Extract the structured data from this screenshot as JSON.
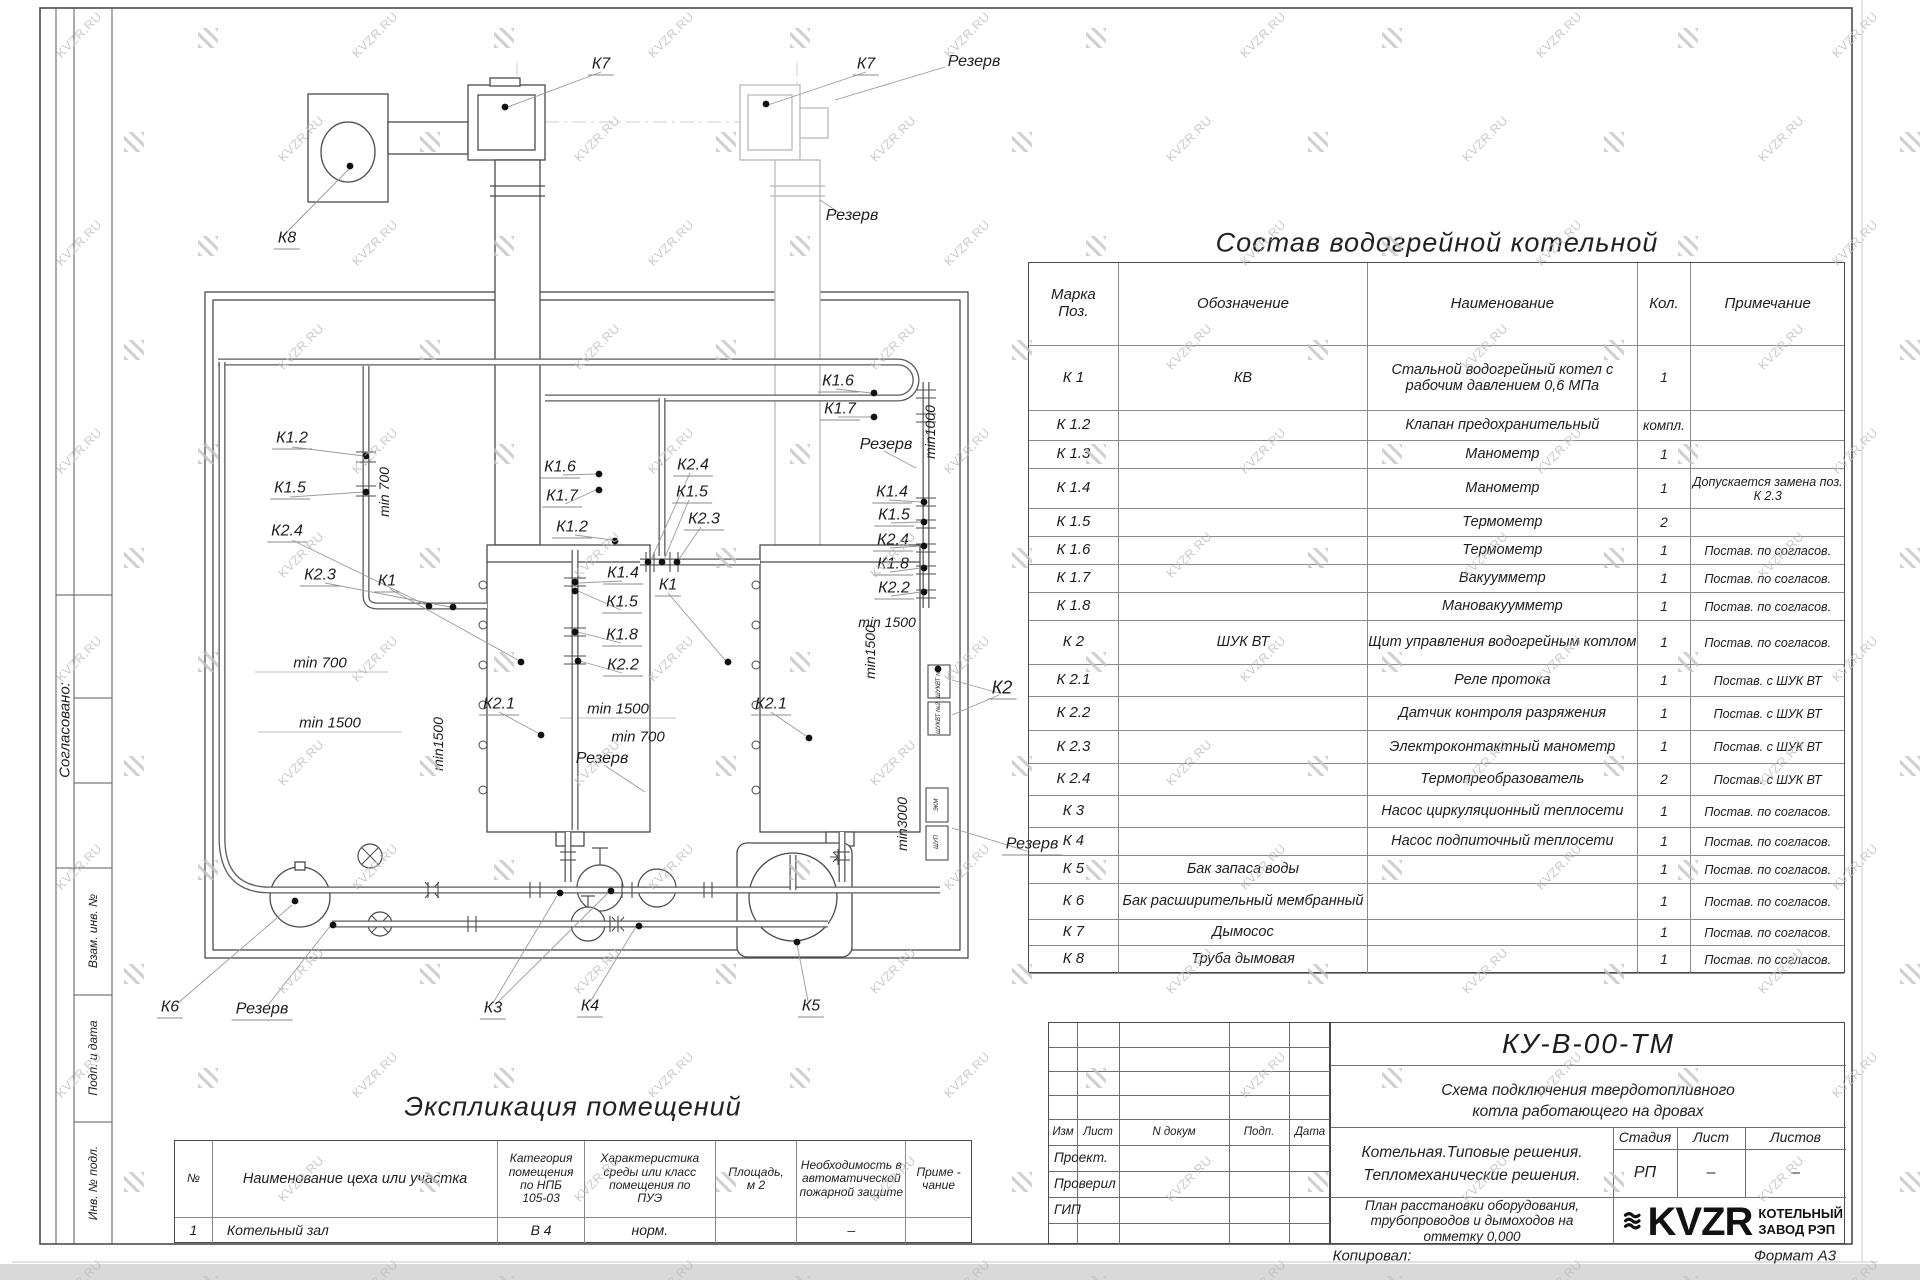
{
  "sheet": {
    "watermark": "KVZR.RU",
    "copied_label": "Копировал:",
    "format_note": "Формат А3"
  },
  "side_labels": {
    "agreed": "Согласовано:",
    "vzam": "Взам. инв. №",
    "podp": "Подп. и дата",
    "inv": "Инв. № подл."
  },
  "equipment_table": {
    "title": "Состав водогрейной котельной",
    "headers": [
      "Марка\nПоз.",
      "Обозначение",
      "Наименование",
      "Кол.",
      "Примечание"
    ],
    "rows": [
      [
        "К 1",
        "КВ",
        "Стальной водогрейный котел с рабочим давлением 0,6  МПа",
        "1",
        ""
      ],
      [
        "К 1.2",
        "",
        "Клапан предохранительный",
        "компл.",
        ""
      ],
      [
        "К 1.3",
        "",
        "Манометр",
        "1",
        ""
      ],
      [
        "К 1.4",
        "",
        "Манометр",
        "1",
        "Допускается замена поз. К 2.3"
      ],
      [
        "К 1.5",
        "",
        "Термометр",
        "2",
        ""
      ],
      [
        "К 1.6",
        "",
        "Термометр",
        "1",
        "Постав. по согласов."
      ],
      [
        "К 1.7",
        "",
        "Вакуумметр",
        "1",
        "Постав. по согласов."
      ],
      [
        "К 1.8",
        "",
        "Мановакуумметр",
        "1",
        "Постав. по согласов."
      ],
      [
        "К 2",
        "ШУК ВТ",
        "Щит управления водогрейным котлом",
        "1",
        "Постав. по согласов."
      ],
      [
        "К 2.1",
        "",
        "Реле протока",
        "1",
        "Постав. с ШУК ВТ"
      ],
      [
        "К 2.2",
        "",
        "Датчик контроля разряжения",
        "1",
        "Постав. с ШУК ВТ"
      ],
      [
        "К 2.3",
        "",
        "Электроконтактный манометр",
        "1",
        "Постав. с ШУК ВТ"
      ],
      [
        "К 2.4",
        "",
        "Термопреобразователь",
        "2",
        "Постав. с ШУК ВТ"
      ],
      [
        "К 3",
        "",
        "Насос циркуляционный теплосети",
        "1",
        "Постав. по согласов."
      ],
      [
        "К 4",
        "",
        "Насос подпиточный теплосети",
        "1",
        "Постав. по согласов."
      ],
      [
        "К 5",
        "Бак запаса воды",
        "",
        "1",
        "Постав. по согласов."
      ],
      [
        "К 6",
        "Бак расширительный мембранный",
        "",
        "1",
        "Постав. по согласов."
      ],
      [
        "К 7",
        "Дымосос",
        "",
        "1",
        "Постав. по согласов."
      ],
      [
        "К 8",
        "Труба дымовая",
        "",
        "1",
        "Постав. по согласов."
      ]
    ]
  },
  "rooms_table": {
    "title": "Экспликация помещений",
    "headers": [
      "№",
      "Наименование цеха или участка",
      "Категория\nпомещения\nпо НПБ\n105-03",
      "Характеристика\nсреды или класс\nпомещения по\nПУЭ",
      "Площадь,\nм 2",
      "Необходимость в\nавтоматической\nпожарной защите",
      "Приме -\nчание"
    ],
    "rows": [
      [
        "1",
        "Котельный зал",
        "В 4",
        "норм.",
        "",
        "–",
        ""
      ]
    ]
  },
  "title_block": {
    "doc_number": "КУ-В-00-ТМ",
    "doc_title_line1": "Схема подключения твердотопливного",
    "doc_title_line2": "котла работающего на дровах",
    "rev_headers": [
      "Изм",
      "Лист",
      "N докум",
      "Подп.",
      "Дата"
    ],
    "roles": [
      "Проект.",
      "Проверил",
      "ГИП"
    ],
    "project_line1": "Котельная.Типовые решения.",
    "project_line2": "Тепломеханические решения.",
    "sheet_title": "План расстановки оборудования,\nтрубопроводов и дымоходов на\nотметку  0,000",
    "stage_headers": [
      "Стадия",
      "Лист",
      "Листов"
    ],
    "stage_values": [
      "РП",
      "–",
      "–"
    ],
    "logo_text": "KVZR",
    "company_line1": "КОТЕЛЬНЫЙ",
    "company_line2": "ЗАВОД РЭП"
  },
  "drawing": {
    "labels": [
      {
        "t": "К7",
        "x": 601,
        "y": 66,
        "u": 1
      },
      {
        "t": "К7",
        "x": 866,
        "y": 66,
        "u": 1
      },
      {
        "t": "Резерв",
        "x": 974,
        "y": 62
      },
      {
        "t": "К8",
        "x": 287,
        "y": 240,
        "u": 1
      },
      {
        "t": "Резерв",
        "x": 852,
        "y": 216
      },
      {
        "t": "min1000",
        "x": 930,
        "y": 432,
        "r": -90,
        "s": 14
      },
      {
        "t": "К1.2",
        "x": 292,
        "y": 440,
        "u": 1
      },
      {
        "t": "К1.5",
        "x": 290,
        "y": 490,
        "u": 1
      },
      {
        "t": "К2.4",
        "x": 287,
        "y": 533,
        "u": 1
      },
      {
        "t": "К2.3",
        "x": 320,
        "y": 577,
        "u": 1
      },
      {
        "t": "К1",
        "x": 387,
        "y": 583,
        "u": 1
      },
      {
        "t": "min 700",
        "x": 384,
        "y": 492,
        "r": -90,
        "s": 14
      },
      {
        "t": "min 700",
        "x": 320,
        "y": 663,
        "s": 15
      },
      {
        "t": "min 1500",
        "x": 330,
        "y": 723,
        "s": 15
      },
      {
        "t": "min1500",
        "x": 438,
        "y": 744,
        "r": -90,
        "s": 14
      },
      {
        "t": "К1.6",
        "x": 560,
        "y": 469,
        "u": 1
      },
      {
        "t": "К1.7",
        "x": 562,
        "y": 498,
        "u": 1
      },
      {
        "t": "К1.2",
        "x": 572,
        "y": 529,
        "u": 1
      },
      {
        "t": "К2.4",
        "x": 693,
        "y": 467,
        "u": 1
      },
      {
        "t": "К1.5",
        "x": 692,
        "y": 494,
        "u": 1
      },
      {
        "t": "К2.3",
        "x": 704,
        "y": 521,
        "u": 1
      },
      {
        "t": "К1.4",
        "x": 623,
        "y": 575,
        "u": 1
      },
      {
        "t": "К1",
        "x": 668,
        "y": 587,
        "u": 1
      },
      {
        "t": "К1.5",
        "x": 622,
        "y": 604,
        "u": 1
      },
      {
        "t": "К1.8",
        "x": 622,
        "y": 637,
        "u": 1
      },
      {
        "t": "К2.2",
        "x": 623,
        "y": 667,
        "u": 1
      },
      {
        "t": "min 700",
        "x": 638,
        "y": 737,
        "s": 15
      },
      {
        "t": "К1.6",
        "x": 838,
        "y": 383,
        "u": 1
      },
      {
        "t": "К1.7",
        "x": 840,
        "y": 411,
        "u": 1
      },
      {
        "t": "Резерв",
        "x": 886,
        "y": 445
      },
      {
        "t": "К1.4",
        "x": 892,
        "y": 494,
        "u": 1
      },
      {
        "t": "К1.5",
        "x": 894,
        "y": 517,
        "u": 1
      },
      {
        "t": "К2.4",
        "x": 893,
        "y": 542,
        "u": 1
      },
      {
        "t": "К1.8",
        "x": 893,
        "y": 566,
        "u": 1
      },
      {
        "t": "К2.2",
        "x": 894,
        "y": 590,
        "u": 1
      },
      {
        "t": "min 1500",
        "x": 887,
        "y": 622,
        "s": 14
      },
      {
        "t": "К2.1",
        "x": 499,
        "y": 706,
        "u": 1
      },
      {
        "t": "min 1500",
        "x": 618,
        "y": 709,
        "s": 15
      },
      {
        "t": "Резерв",
        "x": 602,
        "y": 759
      },
      {
        "t": "К2.1",
        "x": 771,
        "y": 706,
        "u": 1
      },
      {
        "t": "min1500",
        "x": 870,
        "y": 652,
        "r": -90,
        "s": 14
      },
      {
        "t": "К2",
        "x": 1002,
        "y": 689,
        "u": 1,
        "s": 18
      },
      {
        "t": "min3000",
        "x": 902,
        "y": 824,
        "r": -90,
        "s": 14
      },
      {
        "t": "Резерв",
        "x": 1032,
        "y": 846,
        "u": 1
      },
      {
        "t": "ШУКВТ №1",
        "x": 939,
        "y": 682,
        "r": -90,
        "s": 6
      },
      {
        "t": "ШУКВТ №2",
        "x": 939,
        "y": 718,
        "r": -90,
        "s": 6
      },
      {
        "t": "ЭКМ",
        "x": 937,
        "y": 805,
        "r": -90,
        "s": 6
      },
      {
        "t": "ШУП",
        "x": 937,
        "y": 842,
        "r": -90,
        "s": 6
      },
      {
        "t": "К6",
        "x": 170,
        "y": 1009,
        "u": 1
      },
      {
        "t": "Резерв",
        "x": 262,
        "y": 1011,
        "u": 1
      },
      {
        "t": "К3",
        "x": 493,
        "y": 1010,
        "u": 1
      },
      {
        "t": "К4",
        "x": 590,
        "y": 1008,
        "u": 1
      },
      {
        "t": "К5",
        "x": 811,
        "y": 1008,
        "u": 1
      }
    ]
  }
}
